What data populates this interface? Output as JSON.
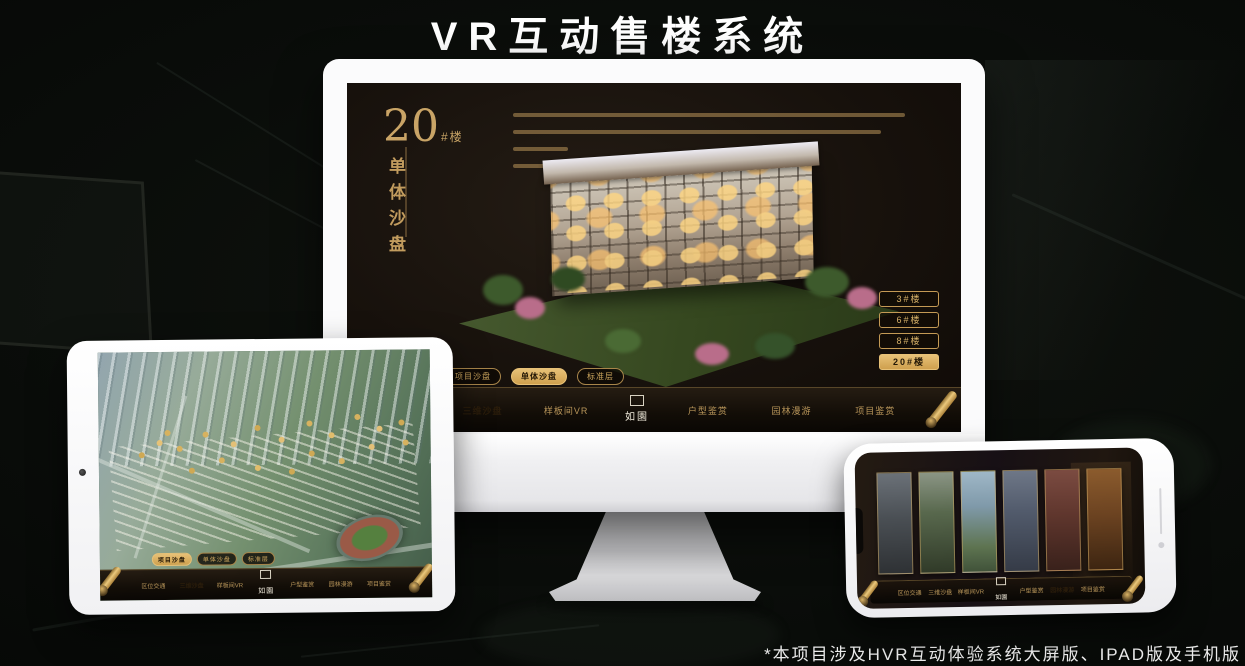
{
  "page": {
    "title": "VR互动售楼系统",
    "footnote": "*本项目涉及HVR互动体验系统大屏版、IPAD版及手机版"
  },
  "brand": {
    "logo": "如園",
    "gold": "#c8a263",
    "gold_active": "#e0b566",
    "screen_bg": "#17110c"
  },
  "monitor": {
    "headline": {
      "number": "20",
      "suffix": "#楼",
      "vertical_title": "单体沙盘"
    },
    "building_tabs": [
      {
        "label": "3#楼",
        "active": false
      },
      {
        "label": "6#楼",
        "active": false
      },
      {
        "label": "8#楼",
        "active": false
      },
      {
        "label": "20#楼",
        "active": true
      }
    ],
    "subtabs": [
      {
        "label": "项目沙盘",
        "active": false
      },
      {
        "label": "单体沙盘",
        "active": true
      },
      {
        "label": "标准层",
        "active": false
      }
    ],
    "nav": {
      "items": [
        {
          "label": "区位交通",
          "active": false
        },
        {
          "label": "三维沙盘",
          "active": true
        },
        {
          "label": "样板间VR",
          "active": false
        },
        {
          "label": "户型鉴赏",
          "active": false
        },
        {
          "label": "园林漫游",
          "active": false
        },
        {
          "label": "项目鉴赏",
          "active": false
        }
      ]
    }
  },
  "tablet": {
    "subtabs": [
      {
        "label": "项目沙盘",
        "active": true
      },
      {
        "label": "单体沙盘",
        "active": false
      },
      {
        "label": "标准层",
        "active": false
      }
    ],
    "nav": {
      "items": [
        {
          "label": "区位交通",
          "active": false
        },
        {
          "label": "三维沙盘",
          "active": true
        },
        {
          "label": "样板间VR",
          "active": false
        },
        {
          "label": "户型鉴赏",
          "active": false
        },
        {
          "label": "园林漫游",
          "active": false
        },
        {
          "label": "项目鉴赏",
          "active": false
        }
      ]
    }
  },
  "phone": {
    "nav": {
      "items": [
        {
          "label": "区位交通",
          "active": false
        },
        {
          "label": "三维沙盘",
          "active": false
        },
        {
          "label": "样板间VR",
          "active": false
        },
        {
          "label": "户型鉴赏",
          "active": false
        },
        {
          "label": "园林漫游",
          "active": true
        },
        {
          "label": "项目鉴赏",
          "active": false
        }
      ]
    }
  }
}
